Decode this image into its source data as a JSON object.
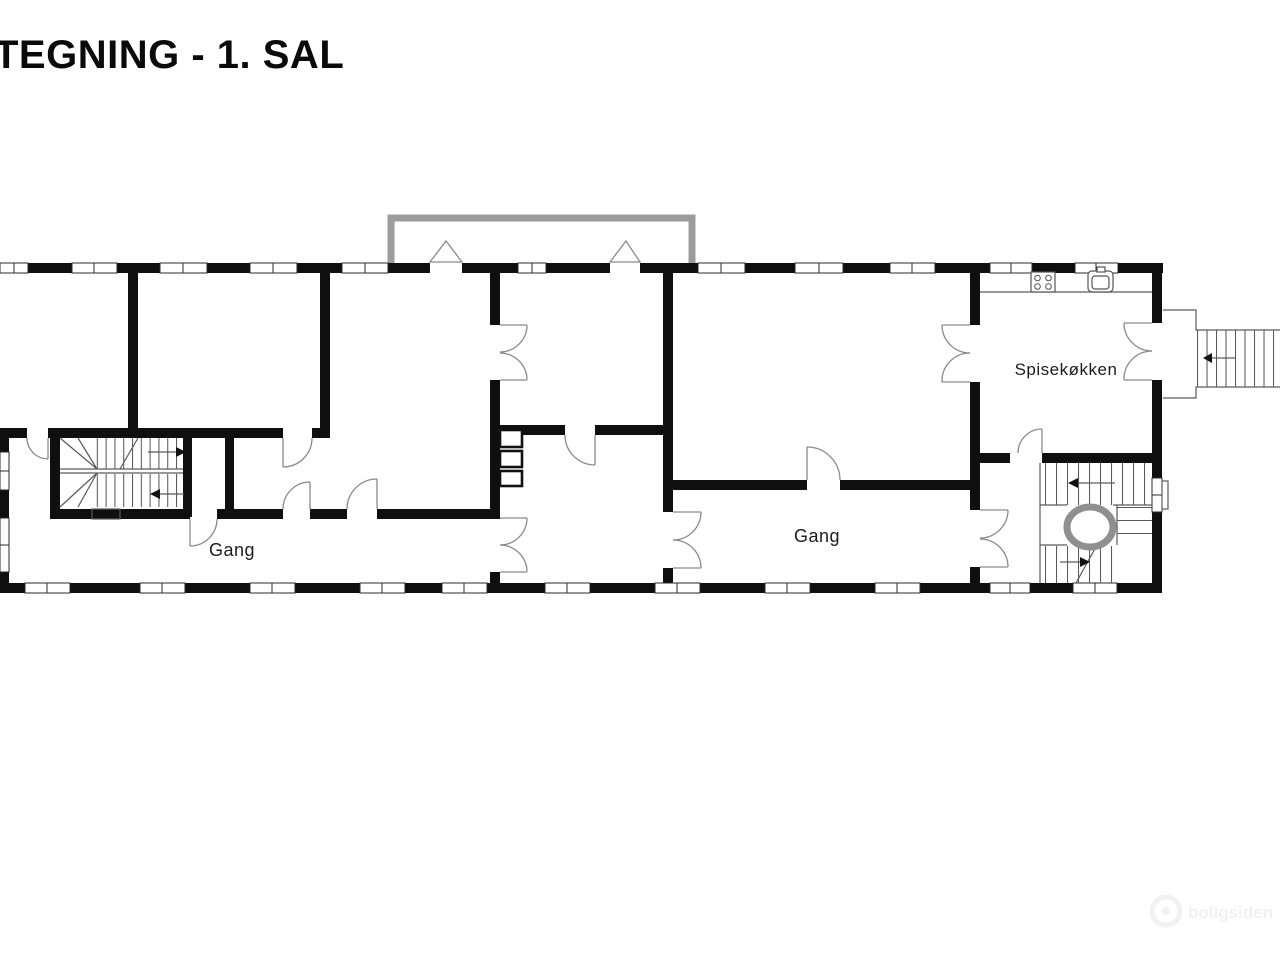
{
  "title": "TEGNING - 1. SAL",
  "rooms": {
    "hall_left": {
      "label": "Gang"
    },
    "hall_right": {
      "label": "Gang"
    },
    "kitchen": {
      "label": "Spisekøkken"
    }
  },
  "icons": {
    "stove": "stove-icon",
    "sink": "sink-icon",
    "oval": "stair-opening-oval"
  },
  "colors": {
    "wall": "#0f0f0f",
    "balcony_gray": "#9c9c9c",
    "oval_gray": "#8f8f8f",
    "thin_line": "#5a5a5a",
    "background": "#ffffff"
  },
  "watermark": {
    "text": "boligsiden"
  }
}
